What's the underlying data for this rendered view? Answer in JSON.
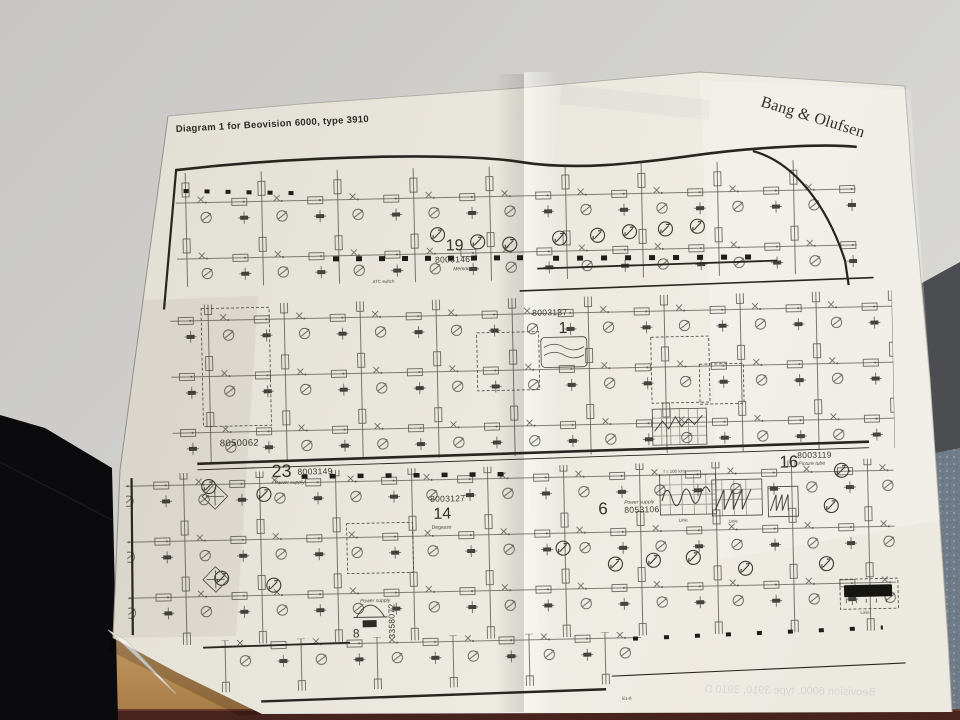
{
  "paper": {
    "title": "Diagram 1 for Beovision 6000, type 3910",
    "brand_logo": "Bang & Olufsen",
    "bleed_through_text": "Beovision 6000, type 3910, 3910 D",
    "edge_label": "E1-8",
    "modules": [
      {
        "number": "19",
        "part": "8003146",
        "caption": "Memory"
      },
      {
        "number": "1",
        "part": "8003137",
        "caption": ""
      },
      {
        "number": "",
        "part": "8050062",
        "caption": ""
      },
      {
        "number": "23",
        "part": "8003149",
        "caption": "Power supply"
      },
      {
        "number": "14",
        "part": "8003127",
        "caption": "Degauss"
      },
      {
        "number": "6",
        "part": "8053106",
        "caption": "Power supply"
      },
      {
        "number": "8",
        "part": "3358072",
        "caption": "Power supply"
      },
      {
        "number": "16",
        "part": "8003119",
        "caption": "Picture tube"
      }
    ],
    "annotations": {
      "atc_switch": "ATC switch",
      "scope_freq": "f = 100 kHz",
      "scope_label_1": "Linie",
      "scope_label_2": "Linie",
      "scope_label_3": "Linie"
    }
  },
  "colors": {
    "background": "#cfcecb",
    "paper": "#eae7de",
    "ink": "#45443d",
    "heavy_line": "#26251f",
    "desk_wood": "#b5894f",
    "desk_edge_strip": "#46231c",
    "dark_object": "#0b0b0d",
    "carpet": "#76818d",
    "floor_shadow": "#4b4d50"
  }
}
